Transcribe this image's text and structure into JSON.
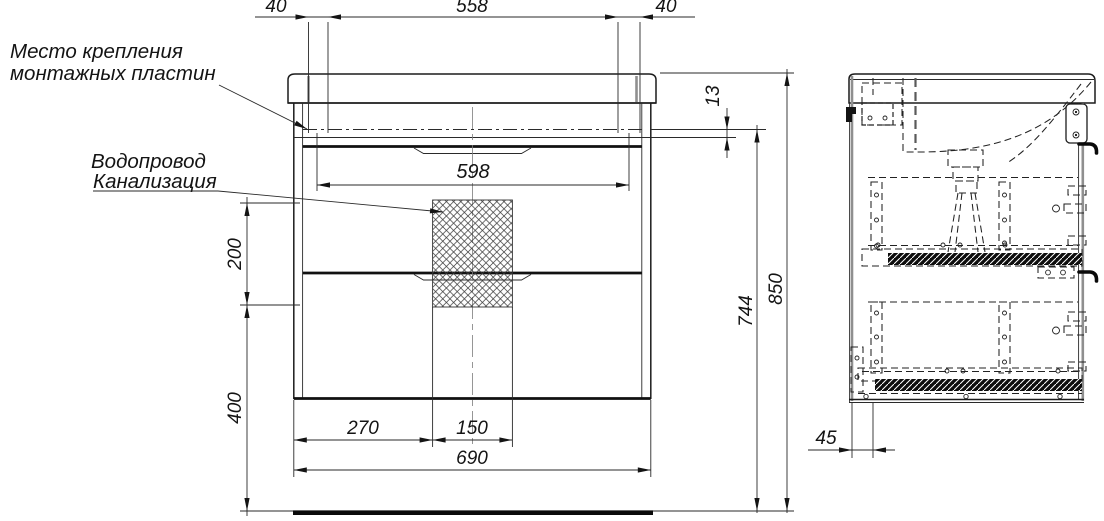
{
  "drawing": {
    "callouts": {
      "mounting": {
        "line1": "Место крепления",
        "line2": "монтажных пластин"
      },
      "plumbing": {
        "line1": "Водопровод",
        "line2": "Канализация"
      }
    },
    "dimensions_mm": {
      "top_left_offset": "40",
      "top_span": "558",
      "top_right_offset": "40",
      "plate_drop": "13",
      "plate_span": "598",
      "pipe_zone_height": "200",
      "pipe_zone_floor_clearance": "400",
      "mount_height": "744",
      "overall_height": "850",
      "pipe_zone_left": "270",
      "pipe_zone_width": "150",
      "cabinet_width": "690",
      "side_back_offset": "45"
    }
  }
}
